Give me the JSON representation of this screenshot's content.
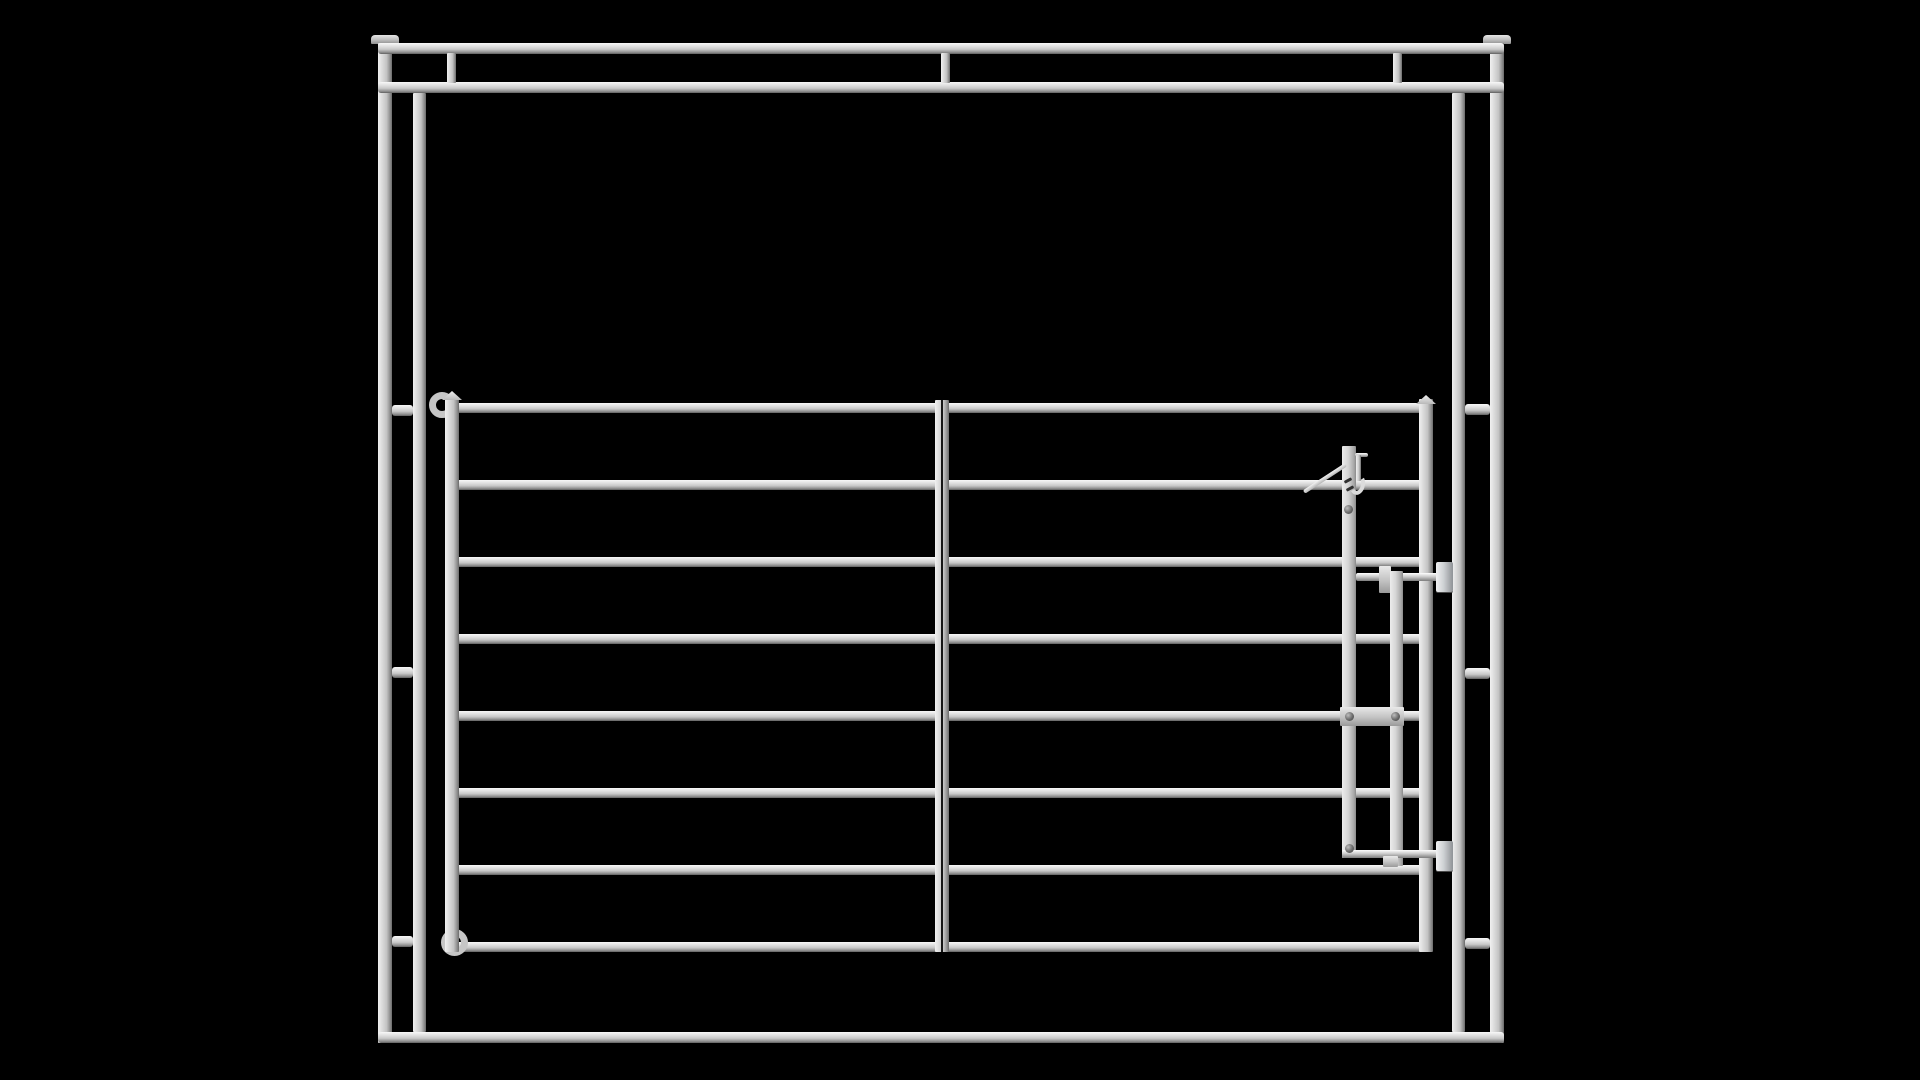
{
  "scene": {
    "background": "#000000",
    "canvas": {
      "width": 1920,
      "height": 1080
    },
    "colors": {
      "metal_highlight": "#f8f8f8",
      "metal_mid": "#c8c8c8",
      "metal_shadow": "#5f5f5f",
      "background": "#000000"
    },
    "parts": [
      {
        "name": "left-post-cap",
        "type": "cap",
        "x": 371,
        "y": 35,
        "w": 28,
        "h": 9
      },
      {
        "name": "right-post-cap",
        "type": "cap",
        "x": 1483,
        "y": 35,
        "w": 28,
        "h": 9
      },
      {
        "name": "outer-post-left",
        "type": "vbar",
        "x": 378,
        "y": 43,
        "w": 14,
        "h": 1000
      },
      {
        "name": "outer-post-right",
        "type": "vbar",
        "x": 1490,
        "y": 43,
        "w": 14,
        "h": 1000
      },
      {
        "name": "frame-top-rail",
        "type": "hbar",
        "x": 378,
        "y": 43,
        "w": 1126,
        "h": 11
      },
      {
        "name": "frame-second-rail",
        "type": "hbar",
        "x": 378,
        "y": 82,
        "w": 1126,
        "h": 11
      },
      {
        "name": "frame-bottom-rail",
        "type": "hbar",
        "x": 378,
        "y": 1032,
        "w": 1126,
        "h": 11
      },
      {
        "name": "top-band-connector-left",
        "type": "vbar",
        "x": 447,
        "y": 53,
        "w": 9,
        "h": 30
      },
      {
        "name": "top-band-connector-center",
        "type": "vbar",
        "x": 941,
        "y": 53,
        "w": 9,
        "h": 30
      },
      {
        "name": "top-band-connector-right",
        "type": "vbar",
        "x": 1393,
        "y": 53,
        "w": 9,
        "h": 30
      },
      {
        "name": "inner-post-left",
        "type": "vbar",
        "x": 413,
        "y": 93,
        "w": 13,
        "h": 939
      },
      {
        "name": "inner-post-right",
        "type": "vbar",
        "x": 1452,
        "y": 93,
        "w": 13,
        "h": 939
      },
      {
        "name": "stub-connector-left-top",
        "type": "hbar",
        "x": 392,
        "y": 405,
        "w": 21,
        "h": 11
      },
      {
        "name": "stub-connector-left-mid",
        "type": "hbar",
        "x": 392,
        "y": 667,
        "w": 21,
        "h": 11
      },
      {
        "name": "stub-connector-left-bottom",
        "type": "hbar",
        "x": 392,
        "y": 936,
        "w": 21,
        "h": 11
      },
      {
        "name": "stub-connector-right-top",
        "type": "hbar",
        "x": 1465,
        "y": 404,
        "w": 25,
        "h": 11
      },
      {
        "name": "stub-connector-right-mid",
        "type": "hbar",
        "x": 1465,
        "y": 668,
        "w": 25,
        "h": 11
      },
      {
        "name": "stub-connector-right-bottom",
        "type": "hbar",
        "x": 1465,
        "y": 938,
        "w": 25,
        "h": 11
      },
      {
        "name": "gate-rail-1",
        "type": "hbar",
        "x": 452,
        "y": 403,
        "w": 974,
        "h": 10
      },
      {
        "name": "gate-rail-2",
        "type": "hbar",
        "x": 452,
        "y": 480,
        "w": 974,
        "h": 10
      },
      {
        "name": "gate-rail-3",
        "type": "hbar",
        "x": 452,
        "y": 557,
        "w": 974,
        "h": 10
      },
      {
        "name": "gate-rail-4",
        "type": "hbar",
        "x": 452,
        "y": 634,
        "w": 974,
        "h": 10
      },
      {
        "name": "gate-rail-5",
        "type": "hbar",
        "x": 452,
        "y": 711,
        "w": 974,
        "h": 10
      },
      {
        "name": "gate-rail-6",
        "type": "hbar",
        "x": 452,
        "y": 788,
        "w": 974,
        "h": 10
      },
      {
        "name": "gate-rail-7",
        "type": "hbar",
        "x": 452,
        "y": 865,
        "w": 974,
        "h": 10
      },
      {
        "name": "gate-rail-8",
        "type": "hbar",
        "x": 452,
        "y": 942,
        "w": 974,
        "h": 10
      },
      {
        "name": "hinge-curl-top",
        "type": "ring",
        "x": 429,
        "y": 392,
        "w": 26,
        "h": 26
      },
      {
        "name": "hinge-curl-bottom",
        "type": "ring",
        "x": 441,
        "y": 929,
        "w": 27,
        "h": 27
      },
      {
        "name": "gate-stile-left",
        "type": "vbar",
        "x": 445,
        "y": 399,
        "w": 14,
        "h": 553
      },
      {
        "name": "gate-stile-center",
        "type": "vbar",
        "x": 935,
        "y": 400,
        "w": 14,
        "h": 552
      },
      {
        "name": "gate-center-seam",
        "type": "seam",
        "x": 941,
        "y": 400,
        "w": 2,
        "h": 552
      },
      {
        "name": "gate-stile-right",
        "type": "vbar",
        "x": 1419,
        "y": 399,
        "w": 14,
        "h": 553
      },
      {
        "name": "stile-cap-left",
        "type": "pyramid",
        "x": 442,
        "y": 391,
        "w": 20,
        "h": 9
      },
      {
        "name": "stile-cap-right",
        "type": "pyramid",
        "x": 1416,
        "y": 395,
        "w": 20,
        "h": 9
      },
      {
        "name": "latch-bar-main",
        "type": "vbarflat",
        "x": 1342,
        "y": 446,
        "w": 14,
        "h": 412
      },
      {
        "name": "latch-top-pin",
        "type": "rod",
        "x": 1355,
        "y": 453,
        "w": 13,
        "h": 4
      },
      {
        "name": "latch-hook-shaft",
        "type": "vbar",
        "x": 1356,
        "y": 455,
        "w": 5,
        "h": 26
      },
      {
        "name": "latch-hook-curl",
        "type": "curl",
        "x": 1350,
        "y": 474,
        "w": 15,
        "h": 21
      },
      {
        "name": "latch-lever",
        "type": "lever",
        "x": 1304,
        "y": 490,
        "w": 50,
        "h": 4,
        "rot": -33
      },
      {
        "name": "latch-mark-1",
        "type": "mark",
        "x": 1344,
        "y": 479,
        "w": 8,
        "h": 3,
        "rot": -28
      },
      {
        "name": "latch-mark-2",
        "type": "mark",
        "x": 1346,
        "y": 487,
        "w": 8,
        "h": 3,
        "rot": -28
      },
      {
        "name": "latch-pivot-bolt",
        "type": "bolt",
        "x": 1344,
        "y": 505,
        "w": 9,
        "h": 9
      },
      {
        "name": "latch-upper-rod",
        "type": "rod",
        "x": 1356,
        "y": 573,
        "w": 84,
        "h": 8
      },
      {
        "name": "latch-upper-guide",
        "type": "plate",
        "x": 1379,
        "y": 566,
        "w": 12,
        "h": 27
      },
      {
        "name": "latch-bar-second",
        "type": "vbarflat",
        "x": 1390,
        "y": 571,
        "w": 13,
        "h": 295
      },
      {
        "name": "latch-upper-keeper",
        "type": "block",
        "x": 1436,
        "y": 562,
        "w": 17,
        "h": 30
      },
      {
        "name": "latch-link-plate",
        "type": "plate",
        "x": 1340,
        "y": 707,
        "w": 64,
        "h": 19
      },
      {
        "name": "latch-link-bolt-left",
        "type": "bolt",
        "x": 1345,
        "y": 712,
        "w": 9,
        "h": 9
      },
      {
        "name": "latch-link-bolt-right",
        "type": "bolt",
        "x": 1391,
        "y": 712,
        "w": 9,
        "h": 9
      },
      {
        "name": "latch-lower-rod",
        "type": "rod",
        "x": 1342,
        "y": 850,
        "w": 98,
        "h": 8
      },
      {
        "name": "latch-lower-keeper",
        "type": "block",
        "x": 1436,
        "y": 841,
        "w": 17,
        "h": 30
      },
      {
        "name": "latch-lower-bolt",
        "type": "bolt",
        "x": 1345,
        "y": 844,
        "w": 9,
        "h": 9
      },
      {
        "name": "latch-bottom-tab",
        "type": "plate",
        "x": 1383,
        "y": 856,
        "w": 15,
        "h": 11
      }
    ]
  }
}
